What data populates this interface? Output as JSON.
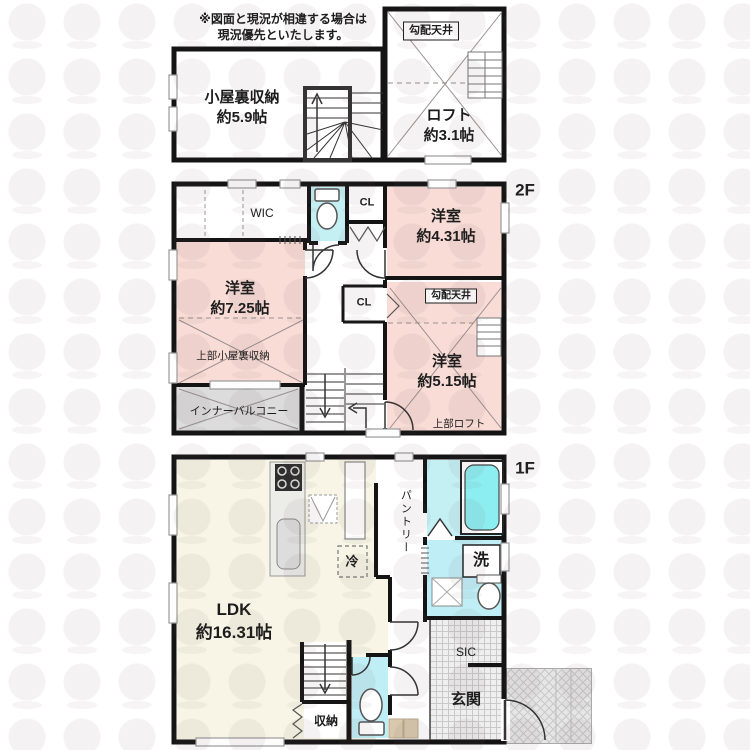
{
  "colors": {
    "room_pink": "#f9dcd6",
    "room_cyan": "#c4f0f4",
    "room_cyan_deep": "#bfeef6",
    "tub_fill": "#8deef1",
    "ldk_cream": "#f8f5e6",
    "balcony_gray": "#dcdcdc",
    "wall_black": "#141414",
    "step_beige": "#d8c9ae"
  },
  "notice": {
    "line1": "※図面と現況が相違する場合は",
    "line2": "現況優先といたします。"
  },
  "attic": {
    "sloped_ceiling": "勾配天井",
    "storage_name": "小屋裏収納",
    "storage_size": "約5.9帖",
    "loft_name": "ロフト",
    "loft_size": "約3.1帖"
  },
  "f2": {
    "floor_label": "2F",
    "wic": "WIC",
    "cl_top": "CL",
    "cl_mid": "CL",
    "room431_name": "洋室",
    "room431_size": "約4.31帖",
    "room725_name": "洋室",
    "room725_size": "約7.25帖",
    "room515_name": "洋室",
    "room515_size": "約5.15帖",
    "upper_attic_storage": "上部小屋裏収納",
    "inner_balcony": "インナーバルコニー",
    "sloped_ceiling": "勾配天井",
    "upper_loft": "上部ロフト"
  },
  "f1": {
    "floor_label": "1F",
    "ldk_name": "LDK",
    "ldk_size": "約16.31帖",
    "pantry": "パントリー",
    "fridge": "冷",
    "laundry": "洗",
    "storage": "収納",
    "sic": "SIC",
    "entrance": "玄関"
  }
}
